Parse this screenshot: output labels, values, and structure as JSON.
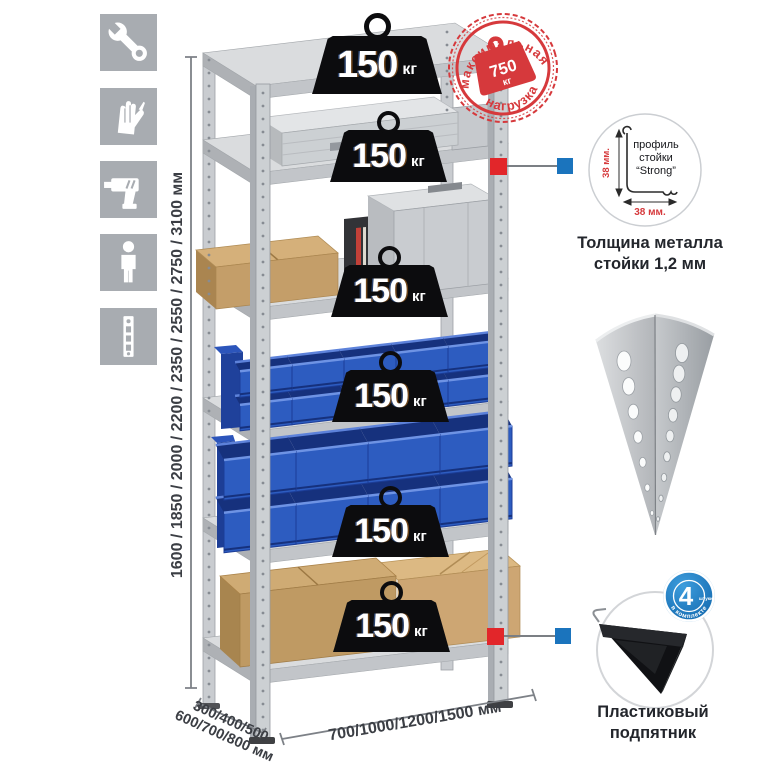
{
  "page": {
    "background": "#ffffff"
  },
  "legend_icons": [
    {
      "name": "wrench"
    },
    {
      "name": "gloves"
    },
    {
      "name": "drill"
    },
    {
      "name": "person"
    },
    {
      "name": "rack-post"
    }
  ],
  "dimensions": {
    "height_label": "1600 / 1850 / 2000 / 2200 / 2350 / 2550 / 2750 / 3100 мм",
    "depth_label_line1": "300/400/500",
    "depth_label_line2": "600/700/800 мм",
    "width_label": "700/1000/1200/1500 мм"
  },
  "shelf_loads": [
    {
      "value": "150",
      "unit": "кг"
    },
    {
      "value": "150",
      "unit": "кг"
    },
    {
      "value": "150",
      "unit": "кг"
    },
    {
      "value": "150",
      "unit": "кг"
    },
    {
      "value": "150",
      "unit": "кг"
    },
    {
      "value": "150",
      "unit": "кг"
    }
  ],
  "max_load_stamp": {
    "arc_top": "максимальная",
    "arc_bottom": "нагрузка",
    "value": "750",
    "unit": "кг"
  },
  "profile_detail": {
    "label_line1": "профиль",
    "label_line2": "стойки",
    "label_line3": "“Strong”",
    "vertical_dim": "38 мм.",
    "horizontal_dim": "38 мм.",
    "caption_line1": "Толщина металла",
    "caption_line2": "стойки 1,2 мм"
  },
  "foot_detail": {
    "badge_value": "4",
    "badge_unit": "штуки",
    "badge_arc": "в комплекте",
    "caption_line1": "Пластиковый",
    "caption_line2": "подпятник"
  },
  "colors": {
    "stamp_red": "#d6393c",
    "connector_red": "#e2262a",
    "connector_blue": "#1b74bd",
    "badge_blue": "#1a7ec2",
    "icon_tile_gray": "#a8acb1",
    "bin_blue": "#2d5cc0",
    "metal_gray": "#ccd0d3",
    "cardboard_tan": "#c49e69",
    "weight_black": "#0c0c0e"
  }
}
